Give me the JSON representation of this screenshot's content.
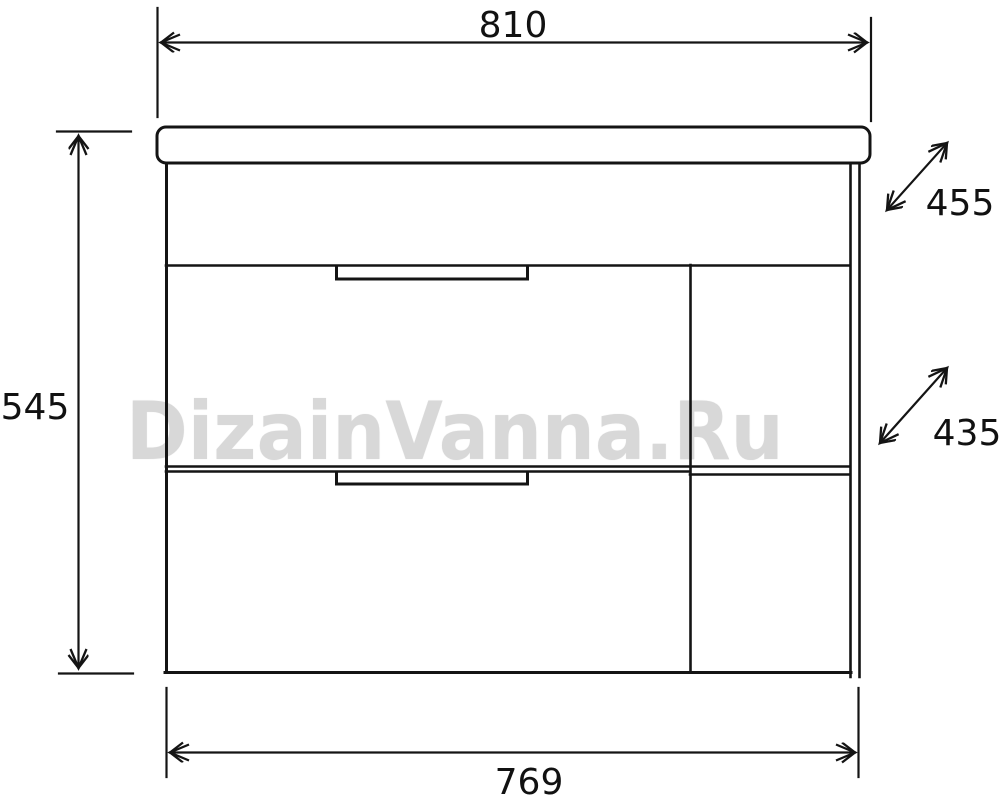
{
  "watermark": {
    "text": "DizainVanna.Ru",
    "color": "#d8d8d8"
  },
  "diagram": {
    "type": "technical-drawing",
    "subject": "vanity cabinet front elevation with dimensions",
    "line_color": "#141414",
    "background_color": "#ffffff",
    "units": "mm (implied, not labeled)",
    "dimensions": {
      "top_width": {
        "label": "810",
        "meaning": "overall countertop width"
      },
      "left_height": {
        "label": "545",
        "meaning": "overall cabinet height"
      },
      "depth_top": {
        "label": "455",
        "meaning": "countertop depth (diagonal callout)"
      },
      "depth_middle": {
        "label": "435",
        "meaning": "cabinet body depth (diagonal callout)"
      },
      "bottom_width": {
        "label": "769",
        "meaning": "cabinet body width"
      }
    },
    "parts": [
      "countertop",
      "upper-apron-panel",
      "drawer-1",
      "drawer-1-handle-recess",
      "drawer-2",
      "drawer-2-handle-recess",
      "right-shelf-section",
      "right-shelf",
      "right-side-panel"
    ]
  }
}
